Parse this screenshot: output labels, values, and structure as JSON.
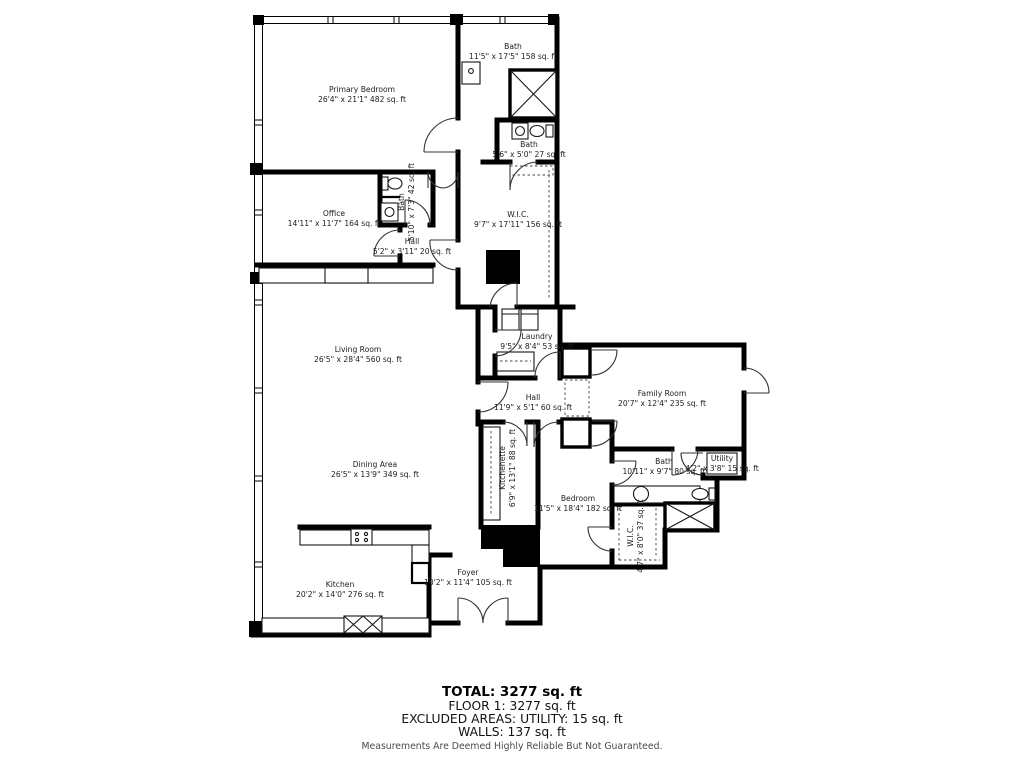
{
  "plan": {
    "rooms": [
      {
        "id": "primary-bedroom",
        "name": "Primary Bedroom",
        "dims": "26'4\" x 21'1\" 482 sq. ft"
      },
      {
        "id": "bath-primary",
        "name": "Bath",
        "dims": "11'5\" x 17'5\" 158 sq. ft"
      },
      {
        "id": "bath-small",
        "name": "Bath",
        "dims": "5'6\" x 5'0\" 27 sq. ft"
      },
      {
        "id": "office",
        "name": "Office",
        "dims": "14'11\" x 11'7\" 164 sq. ft"
      },
      {
        "id": "bath-office",
        "name": "Bath",
        "dims": "5'10\" x 7'3\" 42 sq. ft"
      },
      {
        "id": "hall-small",
        "name": "Hall",
        "dims": "5'2\" x 3'11\" 20 sq. ft"
      },
      {
        "id": "wic-primary",
        "name": "W.I.C.",
        "dims": "9'7\" x 17'11\" 156 sq. ft"
      },
      {
        "id": "living-room",
        "name": "Living Room",
        "dims": "26'5\" x 28'4\" 560 sq. ft"
      },
      {
        "id": "laundry",
        "name": "Laundry",
        "dims": "9'5\" x 8'4\" 53 sq. ft"
      },
      {
        "id": "hall-main",
        "name": "Hall",
        "dims": "11'9\" x 5'1\" 60 sq. ft"
      },
      {
        "id": "family-room",
        "name": "Family Room",
        "dims": "20'7\" x 12'4\" 235 sq. ft"
      },
      {
        "id": "dining-area",
        "name": "Dining Area",
        "dims": "26'5\" x 13'9\" 349 sq. ft"
      },
      {
        "id": "kitchenette",
        "name": "Kitchenette",
        "dims": "6'9\" x 13'1\" 88 sq. ft"
      },
      {
        "id": "bedroom",
        "name": "Bedroom",
        "dims": "11'5\" x 18'4\" 182 sq. ft"
      },
      {
        "id": "bath-bedroom",
        "name": "Bath",
        "dims": "10'11\" x 9'7\" 80 sq. ft"
      },
      {
        "id": "utility",
        "name": "Utility",
        "dims": "4'2\" x 3'8\" 15 sq. ft"
      },
      {
        "id": "wic-bedroom",
        "name": "W.I.C.",
        "dims": "4'7\" x 8'0\" 37 sq. ft"
      },
      {
        "id": "kitchen",
        "name": "Kitchen",
        "dims": "20'2\" x 14'0\" 276 sq. ft"
      },
      {
        "id": "foyer",
        "name": "Foyer",
        "dims": "10'2\" x 11'4\" 105 sq. ft"
      }
    ],
    "summary": {
      "total": "TOTAL: 3277 sq. ft",
      "floor1": "FLOOR 1: 3277 sq. ft",
      "excluded": "EXCLUDED AREAS: UTILITY: 15 sq. ft",
      "walls": "WALLS: 137 sq. ft",
      "disclaimer": "Measurements Are Deemed Highly Reliable But Not Guaranteed."
    },
    "colors": {
      "wall": "#000000",
      "text": "#1c1c1c",
      "disclaimer": "#4a4a4a"
    }
  }
}
